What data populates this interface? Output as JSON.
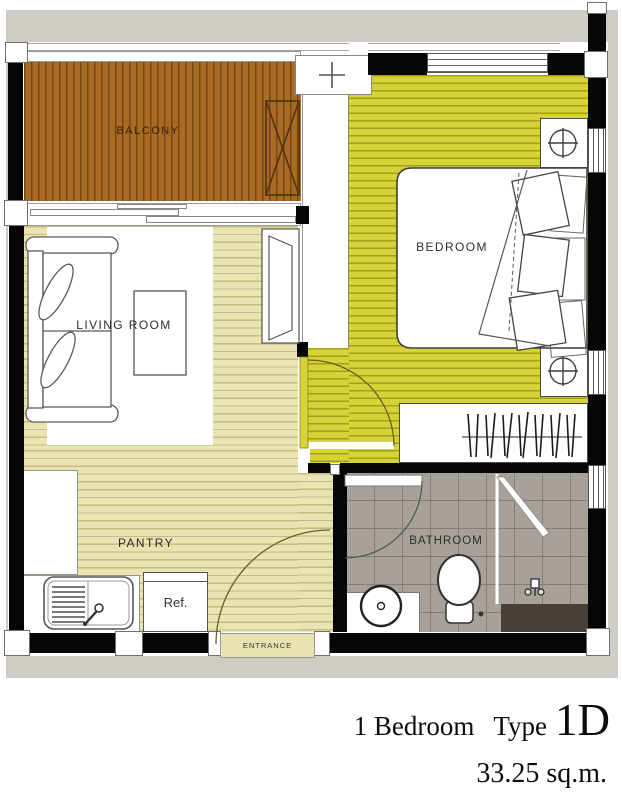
{
  "title": "1 Bedroom Type 1D floor plan",
  "rooms": {
    "balcony": "BALCONY",
    "bedroom": "BEDROOM",
    "living_room": "LIVING ROOM",
    "pantry": "PANTRY",
    "bathroom": "BATHROOM"
  },
  "labels": {
    "entrance": "ENTRANCE",
    "refrigerator": "Ref."
  },
  "caption": {
    "unit": "1 Bedroom",
    "type_word": "Type",
    "type_code": "1D",
    "area": "33.25 sq.m."
  },
  "colors": {
    "wall": "#060606",
    "backdrop": "#cfccc6",
    "balcony_floor": "#a96a24",
    "bedroom_floor": "#d6d23a",
    "pantry_floor": "#eae4b2",
    "bathroom_floor": "#a8a199"
  }
}
